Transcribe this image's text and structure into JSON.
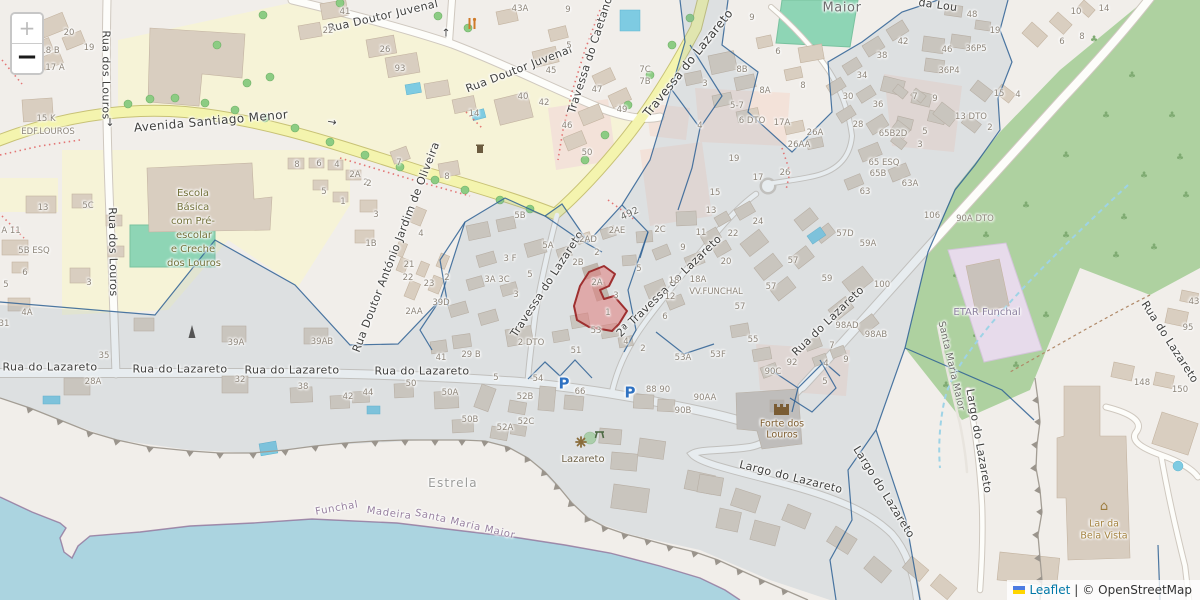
{
  "controls": {
    "zoom_in": "+",
    "zoom_out": "−"
  },
  "attribution": {
    "leaflet": "Leaflet",
    "sep": "|",
    "copyright": "© OpenStreetMap"
  },
  "colors": {
    "water": "#abd4e0",
    "forest": "#aed1a0",
    "landuse_yellow": "#f6f3d7",
    "road_yellow": "#f4f4ae",
    "pitch_teal": "#8ed5b5",
    "overlay_fill": "#7e9ab5",
    "boundary_blue": "#2e6094",
    "highlight_fill": "#e07d7d",
    "highlight_stroke": "#9e2f2f",
    "leaflet_link_blue": "#0078A8",
    "parking_blue": "#2f72c2"
  },
  "labels": [
    {
      "t": "Rua Doutor Juvenal",
      "x": 383,
      "y": 16,
      "r": -13,
      "c": "st"
    },
    {
      "t": "Rua Doutor Juvenal",
      "x": 519,
      "y": 69,
      "r": -21,
      "c": "st"
    },
    {
      "t": "Rua dos Louros",
      "x": 106,
      "y": 75,
      "r": 90,
      "c": "st"
    },
    {
      "t": "→",
      "x": 110,
      "y": 122,
      "r": 90,
      "c": "arr"
    },
    {
      "t": "Rua dos Louros",
      "x": 113,
      "y": 252,
      "r": 89,
      "c": "st"
    },
    {
      "t": "Avenida Santiago Menor",
      "x": 211,
      "y": 121,
      "r": -5,
      "c": "st",
      "s": 12
    },
    {
      "t": "Travessa do Caetano",
      "x": 590,
      "y": 55,
      "r": -72,
      "c": "st"
    },
    {
      "t": "Travessa do Lazareto",
      "x": 688,
      "y": 63,
      "r": -51,
      "c": "st",
      "s": 12
    },
    {
      "t": "Travessa do Lazareto",
      "x": 547,
      "y": 284,
      "r": -57,
      "c": "st"
    },
    {
      "t": "2ª Travessa do Lazareto",
      "x": 669,
      "y": 286,
      "r": -44,
      "c": "st"
    },
    {
      "t": "492",
      "x": 630,
      "y": 214,
      "r": -25,
      "c": "sts"
    },
    {
      "t": "Rua do Lazareto",
      "x": 50,
      "y": 367,
      "c": "st"
    },
    {
      "t": "Rua do Lazareto",
      "x": 180,
      "y": 369,
      "c": "st"
    },
    {
      "t": "Rua do Lazareto",
      "x": 292,
      "y": 370,
      "c": "st"
    },
    {
      "t": "Rua do Lazareto",
      "x": 422,
      "y": 371,
      "c": "st"
    },
    {
      "t": "Rua do Lazareto",
      "x": 828,
      "y": 321,
      "r": -44,
      "c": "st"
    },
    {
      "t": "Rua do Lazareto",
      "x": 1170,
      "y": 342,
      "r": 57,
      "c": "st"
    },
    {
      "t": "Rua Doutor António Jardim de Oliveira",
      "x": 396,
      "y": 247,
      "r": -69,
      "c": "st"
    },
    {
      "t": "Largo do Lazareto",
      "x": 791,
      "y": 477,
      "r": 14,
      "c": "st"
    },
    {
      "t": "Largo do Lazareto",
      "x": 884,
      "y": 492,
      "r": 58,
      "c": "st"
    },
    {
      "t": "Largo do Lazareto",
      "x": 979,
      "y": 441,
      "r": 80,
      "c": "st"
    },
    {
      "t": "Santa Maria Maior",
      "x": 951,
      "y": 366,
      "r": 77,
      "c": "sts"
    },
    {
      "t": "da Lou",
      "x": 938,
      "y": 5,
      "r": 8,
      "c": "st"
    },
    {
      "t": "↑",
      "x": 446,
      "y": 33,
      "c": "arr"
    },
    {
      "t": "→",
      "x": 332,
      "y": 122,
      "r": 10,
      "c": "arr"
    },
    {
      "t": "Maior",
      "x": 842,
      "y": 8,
      "c": "pl"
    },
    {
      "t": "Escola",
      "x": 193,
      "y": 194,
      "c": "sch"
    },
    {
      "t": "Básica",
      "x": 193,
      "y": 208,
      "c": "sch"
    },
    {
      "t": "com Pré-",
      "x": 193,
      "y": 222,
      "c": "sch"
    },
    {
      "t": "escolar",
      "x": 194,
      "y": 236,
      "c": "sch"
    },
    {
      "t": "e Creche",
      "x": 193,
      "y": 250,
      "c": "sch"
    },
    {
      "t": "dos Louros",
      "x": 194,
      "y": 264,
      "c": "sch"
    },
    {
      "t": "ETAR Funchal",
      "x": 987,
      "y": 313,
      "c": "ind"
    },
    {
      "t": "Forte dos",
      "x": 782,
      "y": 424,
      "c": "fort"
    },
    {
      "t": "Louros",
      "x": 782,
      "y": 435,
      "c": "fort"
    },
    {
      "t": "Lazareto",
      "x": 583,
      "y": 460,
      "c": "poi"
    },
    {
      "t": "Estrela",
      "x": 453,
      "y": 483,
      "c": "area"
    },
    {
      "t": "Funchal",
      "x": 337,
      "y": 509,
      "r": -10,
      "c": "adm"
    },
    {
      "t": "Madeira",
      "x": 389,
      "y": 514,
      "r": 8,
      "c": "adm"
    },
    {
      "t": "Santa Maria Maior",
      "x": 465,
      "y": 525,
      "r": 13,
      "c": "adm"
    },
    {
      "t": "Lar da",
      "x": 1104,
      "y": 524,
      "c": "lar"
    },
    {
      "t": "Bela Vista",
      "x": 1104,
      "y": 536,
      "c": "lar"
    },
    {
      "t": "VV.FUNCHAL",
      "x": 716,
      "y": 292,
      "c": "hn"
    },
    {
      "t": "P",
      "x": 564,
      "y": 384,
      "c": "pk"
    },
    {
      "t": "P",
      "x": 630,
      "y": 393,
      "c": "pk"
    },
    {
      "t": "20",
      "x": 69,
      "y": 33
    },
    {
      "t": "18 B",
      "x": 50,
      "y": 51
    },
    {
      "t": "19",
      "x": 89,
      "y": 48
    },
    {
      "t": "17 A",
      "x": 55,
      "y": 68
    },
    {
      "t": "15 K",
      "x": 46,
      "y": 119
    },
    {
      "t": "EDF.LOUROS",
      "x": 48,
      "y": 132
    },
    {
      "t": "13",
      "x": 43,
      "y": 208
    },
    {
      "t": "5C",
      "x": 88,
      "y": 206
    },
    {
      "t": "A 11",
      "x": 11,
      "y": 231
    },
    {
      "t": "5B ESQ",
      "x": 34,
      "y": 251
    },
    {
      "t": "6",
      "x": 25,
      "y": 273
    },
    {
      "t": "5",
      "x": 6,
      "y": 285
    },
    {
      "t": "3",
      "x": 89,
      "y": 283
    },
    {
      "t": "4A",
      "x": 27,
      "y": 313
    },
    {
      "t": "31",
      "x": 4,
      "y": 324
    },
    {
      "t": "35",
      "x": 104,
      "y": 356
    },
    {
      "t": "41",
      "x": 345,
      "y": 12
    },
    {
      "t": "22",
      "x": 328,
      "y": 31
    },
    {
      "t": "26",
      "x": 385,
      "y": 50
    },
    {
      "t": "93",
      "x": 400,
      "y": 69
    },
    {
      "t": "43A",
      "x": 520,
      "y": 9
    },
    {
      "t": "9",
      "x": 568,
      "y": 10
    },
    {
      "t": "14",
      "x": 474,
      "y": 114
    },
    {
      "t": "40",
      "x": 523,
      "y": 97
    },
    {
      "t": "42",
      "x": 544,
      "y": 103
    },
    {
      "t": "45",
      "x": 551,
      "y": 71
    },
    {
      "t": "46",
      "x": 567,
      "y": 126
    },
    {
      "t": "5",
      "x": 569,
      "y": 46
    },
    {
      "t": "47",
      "x": 597,
      "y": 90
    },
    {
      "t": "49",
      "x": 622,
      "y": 110
    },
    {
      "t": "50",
      "x": 587,
      "y": 153
    },
    {
      "t": "7C",
      "x": 645,
      "y": 70
    },
    {
      "t": "7B",
      "x": 645,
      "y": 82
    },
    {
      "t": "8",
      "x": 297,
      "y": 165
    },
    {
      "t": "6",
      "x": 319,
      "y": 164
    },
    {
      "t": "4",
      "x": 337,
      "y": 165
    },
    {
      "t": "2A",
      "x": 355,
      "y": 175
    },
    {
      "t": "2",
      "x": 366,
      "y": 183
    },
    {
      "t": "5",
      "x": 324,
      "y": 192
    },
    {
      "t": "1",
      "x": 343,
      "y": 202
    },
    {
      "t": "3",
      "x": 376,
      "y": 215
    },
    {
      "t": "1B",
      "x": 371,
      "y": 244
    },
    {
      "t": "7",
      "x": 399,
      "y": 163
    },
    {
      "t": "2",
      "x": 369,
      "y": 184
    },
    {
      "t": "8",
      "x": 447,
      "y": 177
    },
    {
      "t": "4",
      "x": 421,
      "y": 234
    },
    {
      "t": "21",
      "x": 409,
      "y": 265
    },
    {
      "t": "22",
      "x": 408,
      "y": 278
    },
    {
      "t": "23",
      "x": 429,
      "y": 284
    },
    {
      "t": "2",
      "x": 447,
      "y": 278
    },
    {
      "t": "2AA",
      "x": 414,
      "y": 312
    },
    {
      "t": "39D",
      "x": 441,
      "y": 303
    },
    {
      "t": "39A",
      "x": 236,
      "y": 343
    },
    {
      "t": "39AB",
      "x": 322,
      "y": 342
    },
    {
      "t": "28A",
      "x": 93,
      "y": 382
    },
    {
      "t": "32",
      "x": 240,
      "y": 380
    },
    {
      "t": "38",
      "x": 303,
      "y": 387
    },
    {
      "t": "42",
      "x": 348,
      "y": 397
    },
    {
      "t": "44",
      "x": 368,
      "y": 393
    },
    {
      "t": "50",
      "x": 411,
      "y": 384
    },
    {
      "t": "50A",
      "x": 450,
      "y": 393
    },
    {
      "t": "50B",
      "x": 470,
      "y": 420
    },
    {
      "t": "5",
      "x": 496,
      "y": 378
    },
    {
      "t": "52A",
      "x": 505,
      "y": 428
    },
    {
      "t": "52B",
      "x": 525,
      "y": 397
    },
    {
      "t": "52C",
      "x": 526,
      "y": 422
    },
    {
      "t": "54",
      "x": 538,
      "y": 379
    },
    {
      "t": "66",
      "x": 580,
      "y": 392
    },
    {
      "t": "88 90",
      "x": 658,
      "y": 390
    },
    {
      "t": "90AA",
      "x": 705,
      "y": 398
    },
    {
      "t": "90B",
      "x": 683,
      "y": 411
    },
    {
      "t": "90C",
      "x": 773,
      "y": 372
    },
    {
      "t": "5",
      "x": 825,
      "y": 382
    },
    {
      "t": "41",
      "x": 441,
      "y": 358
    },
    {
      "t": "29 B",
      "x": 471,
      "y": 355
    },
    {
      "t": "5B",
      "x": 520,
      "y": 216
    },
    {
      "t": "5A",
      "x": 548,
      "y": 246
    },
    {
      "t": "3 F",
      "x": 510,
      "y": 259
    },
    {
      "t": "3A 3C",
      "x": 497,
      "y": 280
    },
    {
      "t": "5",
      "x": 530,
      "y": 275
    },
    {
      "t": "3",
      "x": 516,
      "y": 295
    },
    {
      "t": "2AD",
      "x": 588,
      "y": 240
    },
    {
      "t": "2",
      "x": 597,
      "y": 253
    },
    {
      "t": "2B",
      "x": 578,
      "y": 263
    },
    {
      "t": "2AE",
      "x": 617,
      "y": 231
    },
    {
      "t": "2C",
      "x": 660,
      "y": 230
    },
    {
      "t": "2 DTO",
      "x": 531,
      "y": 343
    },
    {
      "t": "53",
      "x": 596,
      "y": 331
    },
    {
      "t": "51",
      "x": 576,
      "y": 351
    },
    {
      "t": "2A",
      "x": 597,
      "y": 283
    },
    {
      "t": "1",
      "x": 608,
      "y": 313
    },
    {
      "t": "3",
      "x": 616,
      "y": 296
    },
    {
      "t": "5",
      "x": 639,
      "y": 269
    },
    {
      "t": "4",
      "x": 626,
      "y": 342
    },
    {
      "t": "2",
      "x": 643,
      "y": 349
    },
    {
      "t": "53A",
      "x": 683,
      "y": 358
    },
    {
      "t": "53F",
      "x": 718,
      "y": 355
    },
    {
      "t": "55",
      "x": 753,
      "y": 340
    },
    {
      "t": "92",
      "x": 792,
      "y": 363
    },
    {
      "t": "7",
      "x": 832,
      "y": 346
    },
    {
      "t": "4",
      "x": 826,
      "y": 364
    },
    {
      "t": "9",
      "x": 846,
      "y": 360
    },
    {
      "t": "98AD",
      "x": 847,
      "y": 326
    },
    {
      "t": "98AB",
      "x": 876,
      "y": 335
    },
    {
      "t": "100",
      "x": 882,
      "y": 285
    },
    {
      "t": "106",
      "x": 932,
      "y": 216
    },
    {
      "t": "90A DTO",
      "x": 975,
      "y": 219
    },
    {
      "t": "13",
      "x": 711,
      "y": 211
    },
    {
      "t": "22",
      "x": 733,
      "y": 234
    },
    {
      "t": "24",
      "x": 758,
      "y": 222
    },
    {
      "t": "11",
      "x": 701,
      "y": 233
    },
    {
      "t": "9",
      "x": 683,
      "y": 248
    },
    {
      "t": "20",
      "x": 726,
      "y": 262
    },
    {
      "t": "18",
      "x": 674,
      "y": 281
    },
    {
      "t": "18A",
      "x": 698,
      "y": 280
    },
    {
      "t": "12",
      "x": 670,
      "y": 297
    },
    {
      "t": "6",
      "x": 665,
      "y": 317
    },
    {
      "t": "57",
      "x": 793,
      "y": 261
    },
    {
      "t": "57",
      "x": 771,
      "y": 287
    },
    {
      "t": "57",
      "x": 740,
      "y": 307
    },
    {
      "t": "57D",
      "x": 845,
      "y": 234
    },
    {
      "t": "59A",
      "x": 868,
      "y": 244
    },
    {
      "t": "59",
      "x": 827,
      "y": 279
    },
    {
      "t": "9",
      "x": 752,
      "y": 18
    },
    {
      "t": "8B",
      "x": 742,
      "y": 70
    },
    {
      "t": "8A",
      "x": 765,
      "y": 91
    },
    {
      "t": "8",
      "x": 803,
      "y": 86
    },
    {
      "t": "6",
      "x": 778,
      "y": 52
    },
    {
      "t": "3",
      "x": 705,
      "y": 84
    },
    {
      "t": "5-7",
      "x": 737,
      "y": 106
    },
    {
      "t": "6 DTO",
      "x": 752,
      "y": 121
    },
    {
      "t": "17A",
      "x": 782,
      "y": 123
    },
    {
      "t": "4",
      "x": 700,
      "y": 126
    },
    {
      "t": "26A",
      "x": 815,
      "y": 133
    },
    {
      "t": "26AA",
      "x": 799,
      "y": 145
    },
    {
      "t": "26",
      "x": 785,
      "y": 173
    },
    {
      "t": "17",
      "x": 758,
      "y": 178
    },
    {
      "t": "19",
      "x": 734,
      "y": 159
    },
    {
      "t": "15",
      "x": 715,
      "y": 193
    },
    {
      "t": "34",
      "x": 862,
      "y": 76
    },
    {
      "t": "30",
      "x": 848,
      "y": 97
    },
    {
      "t": "36",
      "x": 878,
      "y": 105
    },
    {
      "t": "28",
      "x": 858,
      "y": 125
    },
    {
      "t": "38",
      "x": 882,
      "y": 56
    },
    {
      "t": "42",
      "x": 903,
      "y": 42
    },
    {
      "t": "46",
      "x": 947,
      "y": 50
    },
    {
      "t": "48",
      "x": 972,
      "y": 15
    },
    {
      "t": "19",
      "x": 995,
      "y": 31
    },
    {
      "t": "36P5",
      "x": 976,
      "y": 49
    },
    {
      "t": "36P4",
      "x": 949,
      "y": 71
    },
    {
      "t": "7",
      "x": 915,
      "y": 97
    },
    {
      "t": "9",
      "x": 935,
      "y": 99
    },
    {
      "t": "13 DTO",
      "x": 971,
      "y": 117
    },
    {
      "t": "2",
      "x": 990,
      "y": 128
    },
    {
      "t": "5",
      "x": 925,
      "y": 132
    },
    {
      "t": "3",
      "x": 920,
      "y": 145
    },
    {
      "t": "65B2D",
      "x": 893,
      "y": 134
    },
    {
      "t": "65 ESQ",
      "x": 884,
      "y": 163
    },
    {
      "t": "65B",
      "x": 878,
      "y": 174
    },
    {
      "t": "63A",
      "x": 910,
      "y": 184
    },
    {
      "t": "63",
      "x": 865,
      "y": 192
    },
    {
      "t": "10",
      "x": 1076,
      "y": 12
    },
    {
      "t": "14",
      "x": 1104,
      "y": 9
    },
    {
      "t": "6",
      "x": 1062,
      "y": 42
    },
    {
      "t": "8",
      "x": 1082,
      "y": 37
    },
    {
      "t": "15",
      "x": 999,
      "y": 94
    },
    {
      "t": "4",
      "x": 1018,
      "y": 95
    },
    {
      "t": "148",
      "x": 1142,
      "y": 383
    },
    {
      "t": "150",
      "x": 1180,
      "y": 390
    },
    {
      "t": "95",
      "x": 1188,
      "y": 328
    },
    {
      "t": "43",
      "x": 1194,
      "y": 302
    }
  ]
}
